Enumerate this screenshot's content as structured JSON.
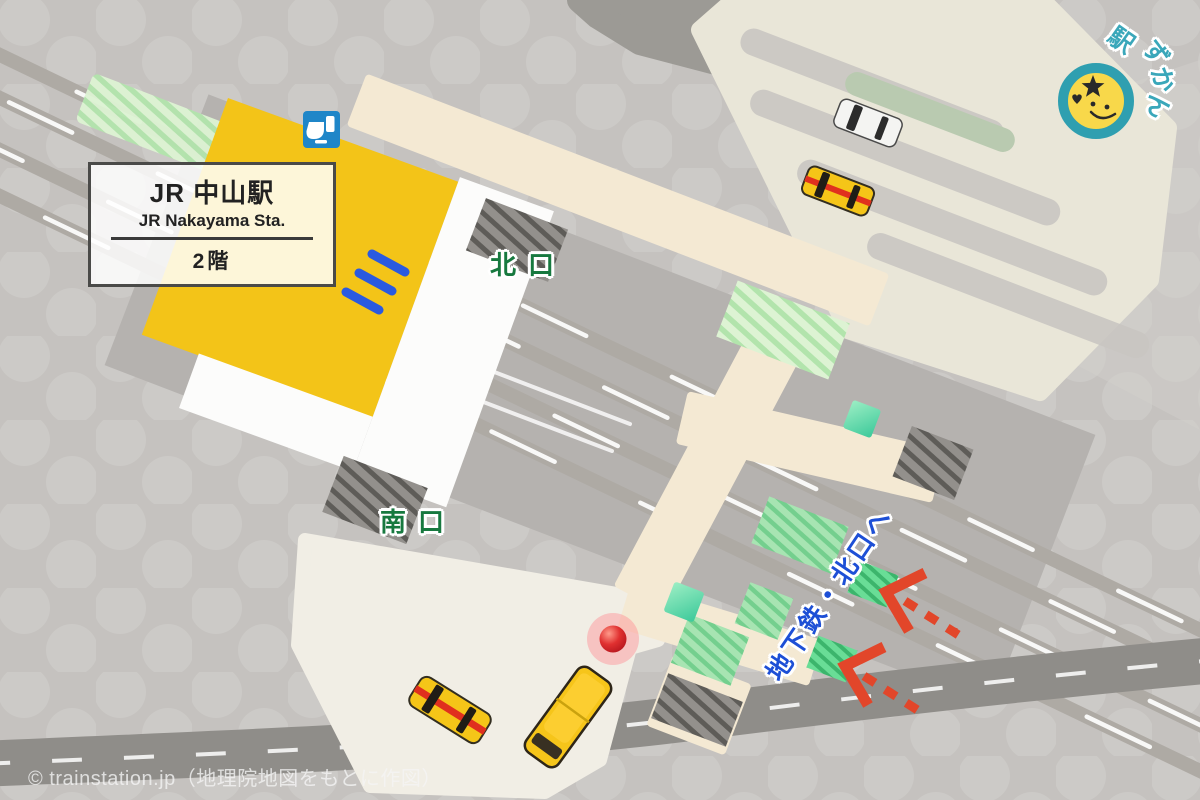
{
  "station_box": {
    "title": "JR 中山駅",
    "subtitle": "JR Nakayama Sta.",
    "floor": "2階"
  },
  "exit_labels": {
    "north": "北口",
    "south": "南口"
  },
  "guidance": {
    "subway_north_note": "地下鉄・北口へ"
  },
  "brand_badge": {
    "full_text": "駅ずかん",
    "char1": "駅",
    "char2": "ず",
    "char3": "か",
    "char4": "ん"
  },
  "footer": {
    "copyright": "© trainstation.jp（地理院地図をもとに作図）"
  },
  "legend_colors": {
    "station_building_yellow": "#f3c418",
    "pedestrian_deck_cream": "#f4e9d3",
    "parking_area_beige": "#e9e6d8",
    "exit_text_green": "#17793f",
    "guidance_text_blue": "#1d4fd6",
    "arrow_red": "#e2462a",
    "badge_teal": "#3aa7ba",
    "track_gray": "#aeaaa4"
  }
}
